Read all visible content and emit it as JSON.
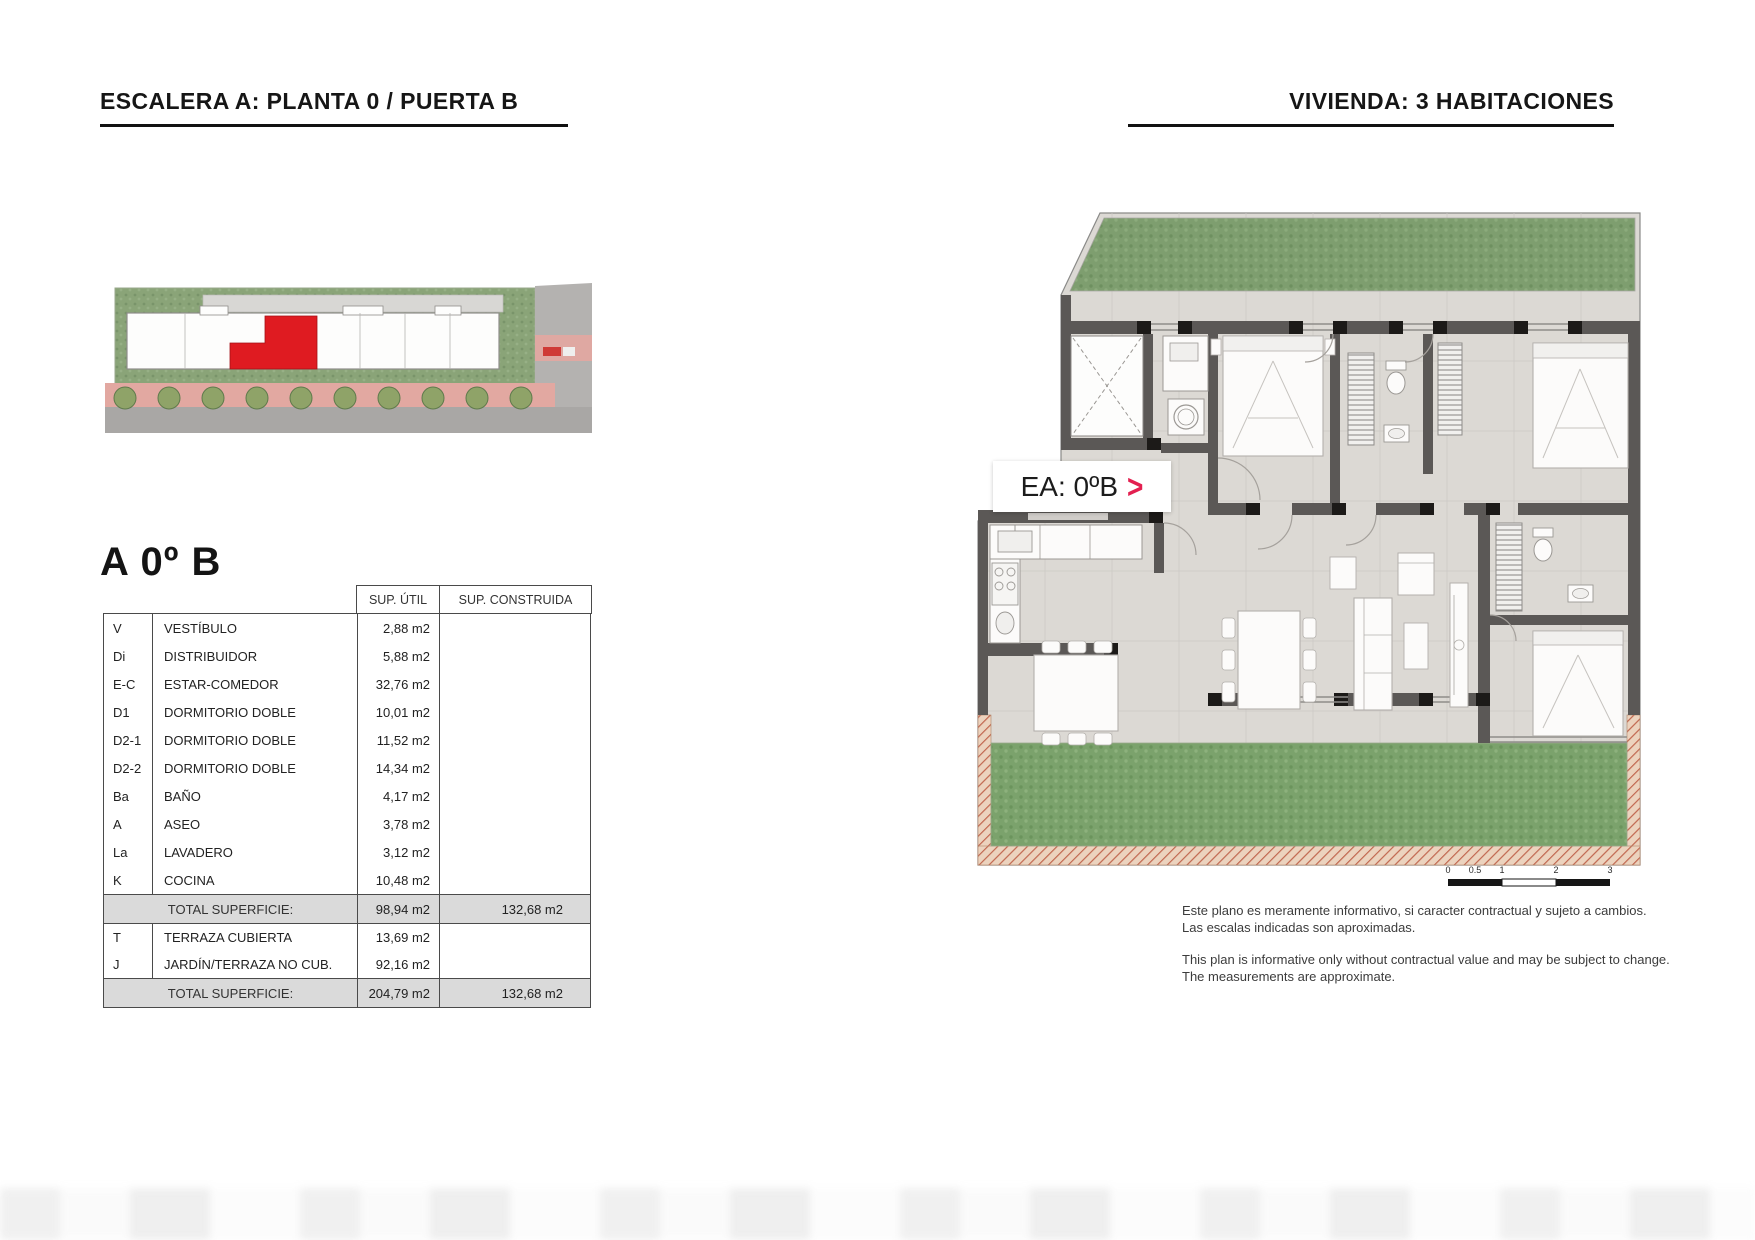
{
  "header": {
    "left_title": "ESCALERA A: PLANTA 0 / PUERTA B",
    "right_title": "VIVIENDA: 3 HABITACIONES"
  },
  "unit": {
    "title": "A 0º B",
    "plan_tag": "EA: 0ºB",
    "plan_tag_arrow": ">"
  },
  "table": {
    "col_sup_util": "SUP. ÚTIL",
    "col_sup_construida": "SUP. CONSTRUIDA",
    "rows": [
      {
        "code": "V",
        "name": "VESTÍBULO",
        "util": "2,88 m2"
      },
      {
        "code": "Di",
        "name": "DISTRIBUIDOR",
        "util": "5,88 m2"
      },
      {
        "code": "E-C",
        "name": "ESTAR-COMEDOR",
        "util": "32,76 m2"
      },
      {
        "code": "D1",
        "name": "DORMITORIO DOBLE",
        "util": "10,01 m2"
      },
      {
        "code": "D2-1",
        "name": "DORMITORIO DOBLE",
        "util": "11,52 m2"
      },
      {
        "code": "D2-2",
        "name": "DORMITORIO DOBLE",
        "util": "14,34 m2"
      },
      {
        "code": "Ba",
        "name": "BAÑO",
        "util": "4,17 m2"
      },
      {
        "code": "A",
        "name": "ASEO",
        "util": "3,78 m2"
      },
      {
        "code": "La",
        "name": "LAVADERO",
        "util": "3,12 m2"
      },
      {
        "code": "K",
        "name": "COCINA",
        "util": "10,48 m2"
      }
    ],
    "total_interior": {
      "label": "TOTAL SUPERFICIE:",
      "util": "98,94 m2",
      "built": "132,68 m2"
    },
    "extra_rows": [
      {
        "code": "T",
        "name": "TERRAZA CUBIERTA",
        "util": "13,69 m2"
      },
      {
        "code": "J",
        "name": "JARDÍN/TERRAZA NO CUB.",
        "util": "92,16 m2"
      }
    ],
    "total_final": {
      "label": "TOTAL SUPERFICIE:",
      "util": "204,79 m2",
      "built": "132,68 m2"
    }
  },
  "plan": {
    "scale_labels": [
      "0",
      "0.5",
      "1",
      "2",
      "3"
    ]
  },
  "disclaimer": {
    "es1": "Este plano es meramente informativo, si caracter contractual y sujeto a cambios.",
    "es2": "Las escalas indicadas son aproximadas.",
    "en1": "This plan is informative only without contractual value and may be subject to change.",
    "en2": "The measurements are approximate."
  },
  "colors": {
    "highlight_red": "#df1b21",
    "arrow_red": "#e32050",
    "grass_green": "#7e9e6f",
    "wall_gray": "#5b5856",
    "hatch_terracotta": "#c1674f"
  }
}
